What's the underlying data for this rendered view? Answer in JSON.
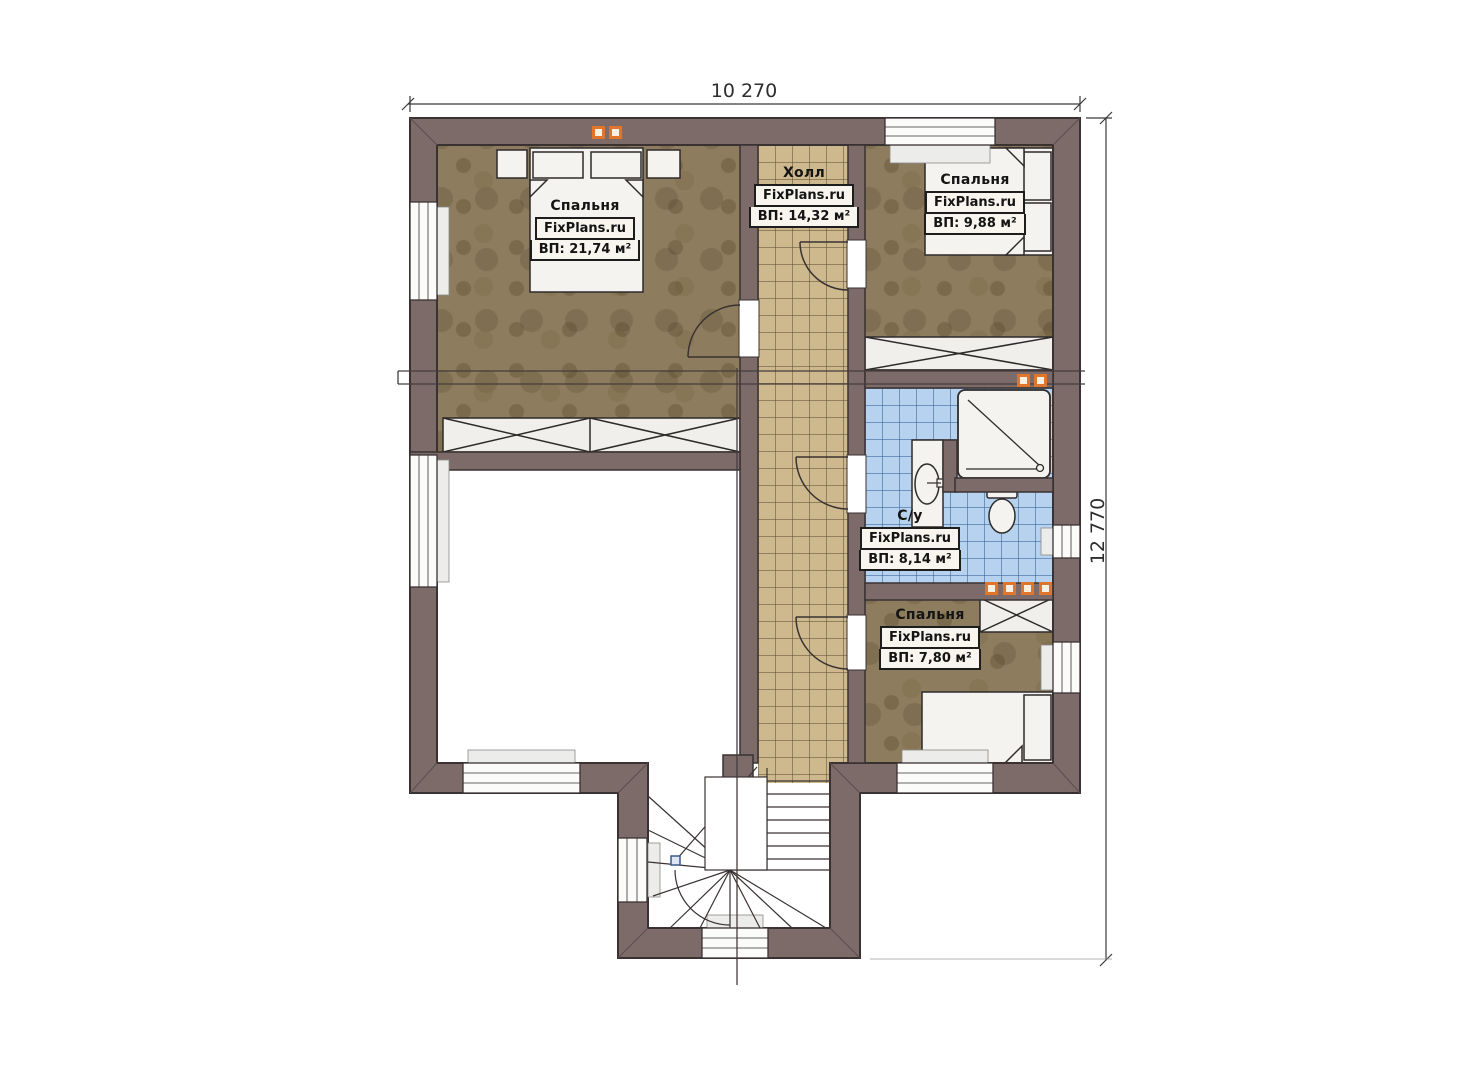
{
  "plan": {
    "watermark": "FixPlans.ru",
    "dimensions": {
      "width": "10 270",
      "height": "12 770"
    },
    "rooms": [
      {
        "name": "Спальня",
        "area": "ВП: 21,74 м²"
      },
      {
        "name": "Холл",
        "area": "ВП: 14,32 м²"
      },
      {
        "name": "Спальня",
        "area": "ВП: 9,88 м²"
      },
      {
        "name": "С/у",
        "area": "ВП: 8,14 м²"
      },
      {
        "name": "Спальня",
        "area": "ВП: 7,80 м²"
      }
    ],
    "colors": {
      "wall": "#7d6b69",
      "bedroom_floor": "#8d7c5d",
      "hall_tile": "#cdb98d",
      "bath_tile": "#b6d2ee",
      "marker": "#e0762c"
    }
  }
}
